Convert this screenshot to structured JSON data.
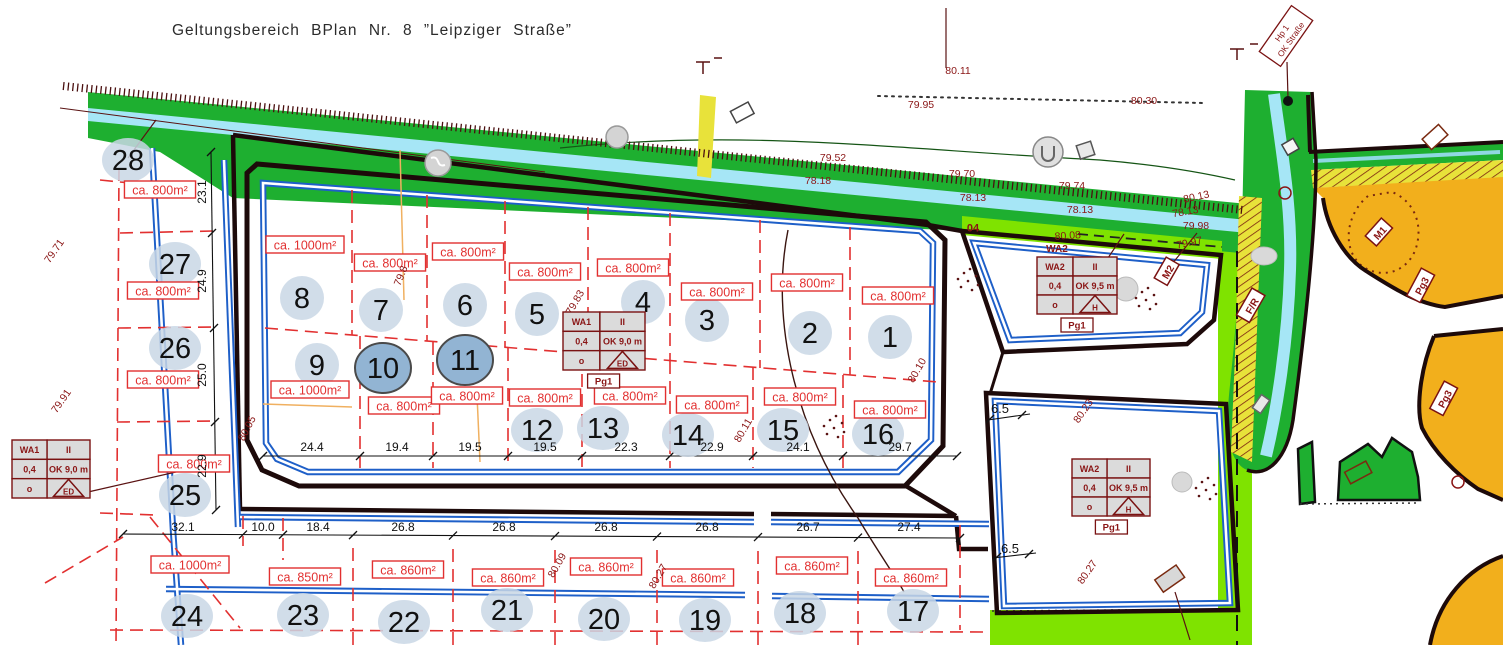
{
  "title": "Geltungsbereich BPlan Nr. 8 ”Leipziger Straße”",
  "plots": [
    {
      "n": "1",
      "cx": 890,
      "cy": 337,
      "area": "ca. 800m²",
      "ax": 898,
      "ay": 296,
      "hl": false
    },
    {
      "n": "2",
      "cx": 810,
      "cy": 333,
      "area": "ca. 800m²",
      "ax": 807,
      "ay": 283,
      "hl": false
    },
    {
      "n": "3",
      "cx": 707,
      "cy": 320,
      "area": "ca. 800m²",
      "ax": 717,
      "ay": 292,
      "hl": false
    },
    {
      "n": "4",
      "cx": 643,
      "cy": 302,
      "area": "ca. 800m²",
      "ax": 633,
      "ay": 268,
      "hl": false
    },
    {
      "n": "5",
      "cx": 537,
      "cy": 314,
      "area": "ca. 800m²",
      "ax": 545,
      "ay": 272,
      "hl": false
    },
    {
      "n": "6",
      "cx": 465,
      "cy": 305,
      "area": "ca. 800m²",
      "ax": 468,
      "ay": 252,
      "hl": false
    },
    {
      "n": "7",
      "cx": 381,
      "cy": 310,
      "area": "ca. 800m²",
      "ax": 390,
      "ay": 263,
      "hl": false
    },
    {
      "n": "8",
      "cx": 302,
      "cy": 298,
      "area": "ca. 1000m²",
      "ax": 305,
      "ay": 245,
      "hl": false
    },
    {
      "n": "9",
      "cx": 317,
      "cy": 365,
      "area": "ca. 1000m²",
      "ax": 310,
      "ay": 390,
      "hl": false
    },
    {
      "n": "10",
      "cx": 383,
      "cy": 368,
      "area": "ca. 800m²",
      "ax": 404,
      "ay": 406,
      "hl": true
    },
    {
      "n": "11",
      "cx": 465,
      "cy": 360,
      "area": "ca. 800m²",
      "ax": 467,
      "ay": 396,
      "hl": true
    },
    {
      "n": "12",
      "cx": 537,
      "cy": 430,
      "area": "ca. 800m²",
      "ax": 545,
      "ay": 398,
      "hl": false
    },
    {
      "n": "13",
      "cx": 603,
      "cy": 428,
      "area": "ca. 800m²",
      "ax": 630,
      "ay": 396,
      "hl": false
    },
    {
      "n": "14",
      "cx": 688,
      "cy": 435,
      "area": "ca. 800m²",
      "ax": 712,
      "ay": 405,
      "hl": false
    },
    {
      "n": "15",
      "cx": 783,
      "cy": 430,
      "area": "ca. 800m²",
      "ax": 800,
      "ay": 397,
      "hl": false
    },
    {
      "n": "16",
      "cx": 878,
      "cy": 434,
      "area": "ca. 800m²",
      "ax": 890,
      "ay": 410,
      "hl": false
    },
    {
      "n": "17",
      "cx": 913,
      "cy": 611,
      "area": "ca. 860m²",
      "ax": 911,
      "ay": 578,
      "hl": false
    },
    {
      "n": "18",
      "cx": 800,
      "cy": 613,
      "area": "ca. 860m²",
      "ax": 812,
      "ay": 566,
      "hl": false
    },
    {
      "n": "19",
      "cx": 705,
      "cy": 620,
      "area": "ca. 860m²",
      "ax": 698,
      "ay": 578,
      "hl": false
    },
    {
      "n": "20",
      "cx": 604,
      "cy": 619,
      "area": "ca. 860m²",
      "ax": 606,
      "ay": 567,
      "hl": false
    },
    {
      "n": "21",
      "cx": 507,
      "cy": 610,
      "area": "ca. 860m²",
      "ax": 508,
      "ay": 578,
      "hl": false
    },
    {
      "n": "22",
      "cx": 404,
      "cy": 622,
      "area": "ca. 860m²",
      "ax": 408,
      "ay": 570,
      "hl": false
    },
    {
      "n": "23",
      "cx": 303,
      "cy": 615,
      "area": "ca. 850m²",
      "ax": 305,
      "ay": 577,
      "hl": false
    },
    {
      "n": "24",
      "cx": 187,
      "cy": 616,
      "area": "ca. 1000m²",
      "ax": 190,
      "ay": 565,
      "hl": false
    },
    {
      "n": "25",
      "cx": 185,
      "cy": 495,
      "area": "ca. 800m²",
      "ax": 194,
      "ay": 464,
      "hl": false
    },
    {
      "n": "26",
      "cx": 175,
      "cy": 348,
      "area": "ca. 800m²",
      "ax": 163,
      "ay": 380,
      "hl": false
    },
    {
      "n": "27",
      "cx": 175,
      "cy": 264,
      "area": "ca. 800m²",
      "ax": 163,
      "ay": 291,
      "hl": false
    },
    {
      "n": "28",
      "cx": 128,
      "cy": 160,
      "area": "ca. 800m²",
      "ax": 160,
      "ay": 190,
      "hl": false
    }
  ],
  "legend_tables": [
    {
      "id": "wa1-west",
      "x": 12,
      "y": 440,
      "w": 78,
      "h": 58,
      "header": "",
      "rows": [
        [
          "WA1",
          "II"
        ],
        [
          "0,4",
          "OK 9,0 m"
        ],
        [
          "o",
          "ED"
        ]
      ],
      "badge": ""
    },
    {
      "id": "wa1-center",
      "x": 563,
      "y": 312,
      "w": 82,
      "h": 58,
      "header": "",
      "rows": [
        [
          "WA1",
          "II"
        ],
        [
          "0,4",
          "OK 9,0 m"
        ],
        [
          "o",
          "ED"
        ]
      ],
      "badge": "Pg1"
    },
    {
      "id": "wa2-north",
      "x": 1037,
      "y": 257,
      "w": 80,
      "h": 57,
      "header": "WA2",
      "rows": [
        [
          "WA2",
          "II"
        ],
        [
          "0,4",
          "OK 9,5 m"
        ],
        [
          "o",
          "H"
        ]
      ],
      "badge": "Pg1"
    },
    {
      "id": "wa2-south",
      "x": 1072,
      "y": 459,
      "w": 78,
      "h": 57,
      "header": "",
      "rows": [
        [
          "WA2",
          "II"
        ],
        [
          "0,4",
          "OK 9,5 m"
        ],
        [
          "o",
          "H"
        ]
      ],
      "badge": "Pg1"
    }
  ],
  "dimensions": {
    "left_chain": [
      {
        "v": "23.1",
        "y": 192
      },
      {
        "v": "24.9",
        "y": 281
      },
      {
        "v": "25.0",
        "y": 375
      },
      {
        "v": "22.9",
        "y": 466
      }
    ],
    "inner_chain": [
      {
        "v": "24.4",
        "x": 312
      },
      {
        "v": "19.4",
        "x": 397
      },
      {
        "v": "19.5",
        "x": 470
      },
      {
        "v": "19.5",
        "x": 545
      },
      {
        "v": "22.3",
        "x": 626
      },
      {
        "v": "22.9",
        "x": 712
      },
      {
        "v": "24.1",
        "x": 798
      },
      {
        "v": "29.7",
        "x": 900
      }
    ],
    "outer_chain": [
      {
        "v": "32.1",
        "x": 183
      },
      {
        "v": "10.0",
        "x": 263
      },
      {
        "v": "18.4",
        "x": 318
      },
      {
        "v": "26.8",
        "x": 403
      },
      {
        "v": "26.8",
        "x": 504
      },
      {
        "v": "26.8",
        "x": 606
      },
      {
        "v": "26.8",
        "x": 707
      },
      {
        "v": "26.7",
        "x": 808
      },
      {
        "v": "27.4",
        "x": 909
      }
    ],
    "right": [
      {
        "v": "6.5",
        "x": 1000,
        "y": 409
      },
      {
        "v": "6.5",
        "x": 1010,
        "y": 549
      }
    ]
  },
  "elevations": [
    {
      "t": "80.11",
      "x": 958,
      "y": 74,
      "r": 0
    },
    {
      "t": "79.95",
      "x": 921,
      "y": 108,
      "r": 0
    },
    {
      "t": "80.30",
      "x": 1144,
      "y": 104,
      "r": 0
    },
    {
      "t": "79.52",
      "x": 833,
      "y": 161,
      "r": 0
    },
    {
      "t": "78.18",
      "x": 818,
      "y": 184,
      "r": 0
    },
    {
      "t": "79.70",
      "x": 962,
      "y": 177,
      "r": 0
    },
    {
      "t": "78.13",
      "x": 973,
      "y": 201,
      "r": 0
    },
    {
      "t": "79.74",
      "x": 1072,
      "y": 189,
      "r": 0
    },
    {
      "t": "78.13",
      "x": 1080,
      "y": 213,
      "r": 0
    },
    {
      "t": "80.13",
      "x": 1197,
      "y": 200,
      "r": -12
    },
    {
      "t": "78.13",
      "x": 1186,
      "y": 215,
      "r": -10
    },
    {
      "t": "79.98",
      "x": 1196,
      "y": 229,
      "r": 0
    },
    {
      "t": "80.08",
      "x": 1068,
      "y": 239,
      "r": -4
    },
    {
      "t": "79.97",
      "x": 1190,
      "y": 246,
      "r": -12
    },
    {
      "t": "79.71",
      "x": 57,
      "y": 253,
      "r": -55
    },
    {
      "t": "79.91",
      "x": 64,
      "y": 403,
      "r": -55
    },
    {
      "t": "80.05",
      "x": 250,
      "y": 430,
      "r": -62
    },
    {
      "t": "79.8",
      "x": 404,
      "y": 277,
      "r": -68
    },
    {
      "t": "79.83",
      "x": 578,
      "y": 304,
      "r": -60
    },
    {
      "t": "80.10",
      "x": 920,
      "y": 372,
      "r": -60
    },
    {
      "t": "80.11",
      "x": 746,
      "y": 432,
      "r": -60
    },
    {
      "t": "80.09",
      "x": 560,
      "y": 567,
      "r": -60
    },
    {
      "t": "80.27",
      "x": 661,
      "y": 578,
      "r": -60
    },
    {
      "t": "80.23",
      "x": 1086,
      "y": 413,
      "r": -55
    },
    {
      "t": "80.27",
      "x": 1090,
      "y": 574,
      "r": -55
    }
  ],
  "zone_tags": [
    {
      "t": "M2",
      "x": 1168,
      "y": 272,
      "r": -60,
      "boxed": true
    },
    {
      "t": "M1",
      "x": 1380,
      "y": 233,
      "r": -48,
      "boxed": true
    },
    {
      "t": "Pg3",
      "x": 1422,
      "y": 286,
      "r": -62,
      "boxed": true
    },
    {
      "t": "Pg3",
      "x": 1445,
      "y": 399,
      "r": -62,
      "boxed": true
    },
    {
      "t": "F/R",
      "x": 1252,
      "y": 306,
      "r": -60,
      "boxed": true
    },
    {
      "t": "No",
      "x": 1101,
      "y": 271,
      "r": -60,
      "boxed": false
    },
    {
      "t": "04",
      "x": 973,
      "y": 228,
      "r": 0,
      "boxed": false
    }
  ],
  "survey_marker": {
    "lines": [
      "Hp 1",
      "OK Straße"
    ],
    "x": 1286,
    "y": 36,
    "r": -55
  },
  "colors": {
    "green": "#1EAF30",
    "bright_green": "#7FE300",
    "stream": "#A6E6F6",
    "yellow": "#E8E23A",
    "orange": "#F2AF1C",
    "street_blue": "#1E5FC8",
    "plan_outline": "#1D0A0A",
    "red": "#E23030",
    "dark_red": "#8A1515",
    "plot_circle": "#C9D7E5",
    "plot_circle_selected": "#92B4D3",
    "table_fill": "#DBDBDB",
    "table_border": "#7A1212"
  }
}
